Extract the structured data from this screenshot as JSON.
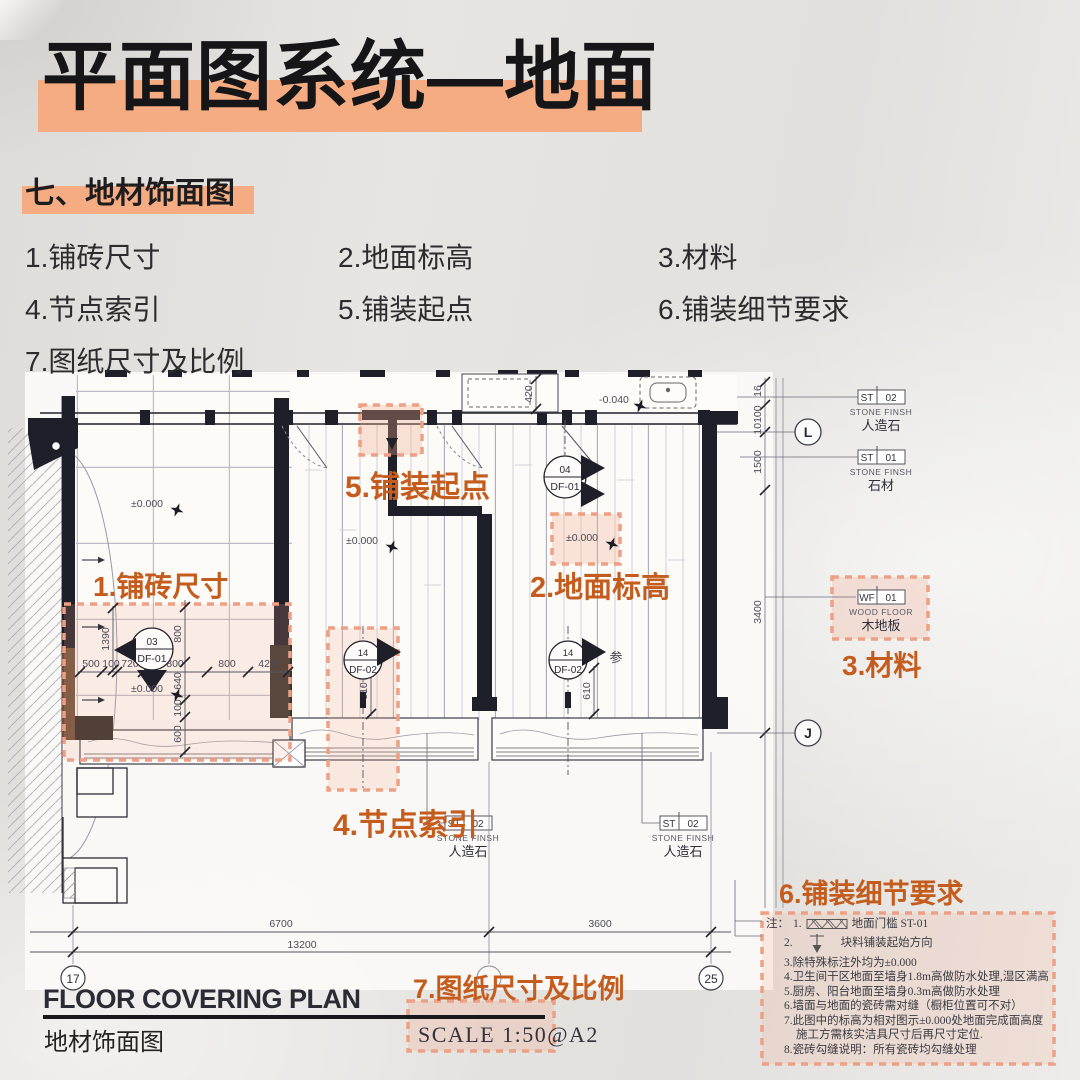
{
  "colors": {
    "highlight": "#f6ac82",
    "annotation_orange": "#c45c1e",
    "dash_pink": "#eda084",
    "title_text": "#161618"
  },
  "header": {
    "title": "平面图系统—地面",
    "section": "七、地材饰面图",
    "legend": [
      "1.铺砖尺寸",
      "2.地面标高",
      "3.材料",
      "4.节点索引",
      "5.铺装起点",
      "6.铺装细节要求",
      "7.图纸尺寸及比例"
    ]
  },
  "plan": {
    "markers": {
      "df01a_num": "03",
      "df01a_code": "DF-01",
      "df01b_num": "04",
      "df01b_code": "DF-01",
      "df02a_num": "14",
      "df02a_code": "DF-02",
      "df02b_num": "14",
      "df02b_code": "DF-02",
      "df02b_ref": "参"
    },
    "levels": {
      "zero": "±0.000",
      "neg": "-0.040"
    },
    "tags": {
      "st02": {
        "code": "ST",
        "num": "02",
        "type": "STONE FINSH",
        "name": "人造石"
      },
      "st01": {
        "code": "ST",
        "num": "01",
        "type": "STONE FINSH",
        "name": "石材"
      },
      "wf01": {
        "code": "WF",
        "num": "01",
        "type": "WOOD FLOOR",
        "name": "木地板"
      }
    },
    "dims": {
      "d500": "500",
      "d100": "100",
      "d720": "720",
      "d800": "800",
      "d420": "420",
      "d1390": "1390",
      "d640": "640",
      "d600": "600",
      "d610": "610",
      "d16": "16",
      "d10100": "10100",
      "d1500": "1500",
      "d3400": "3400",
      "d6700": "6700",
      "d13200": "13200",
      "d3600": "3600"
    },
    "bubbles": {
      "L": "L",
      "J": "J",
      "n17": "17",
      "n25": "25"
    }
  },
  "titleblock": {
    "en": "FLOOR COVERING PLAN",
    "zh": "地材饰面图",
    "scale": "SCALE  1:50@A2"
  },
  "notes": {
    "heading": "6.铺装细节要求",
    "prefix": "注：",
    "i1_num": "1.",
    "i1_text": "地面门槛 ST-01",
    "i2_num": "2.",
    "i2_text": "块料铺装起始方向",
    "lines": [
      "3.除特殊标注外均为±0.000",
      "4.卫生间干区地面至墙身1.8m高做防水处理,湿区满高",
      "5.厨房、阳台地面至墙身0.3m高做防水处理",
      "6.墙面与地面的瓷砖需对缝（橱柜位置可不对）",
      "7.此图中的标高为相对图示±0.000处地面完成面高度",
      "施工方需核实洁具尺寸后再尺寸定位.",
      "8.瓷砖勾缝说明：所有瓷砖均勾缝处理"
    ]
  }
}
